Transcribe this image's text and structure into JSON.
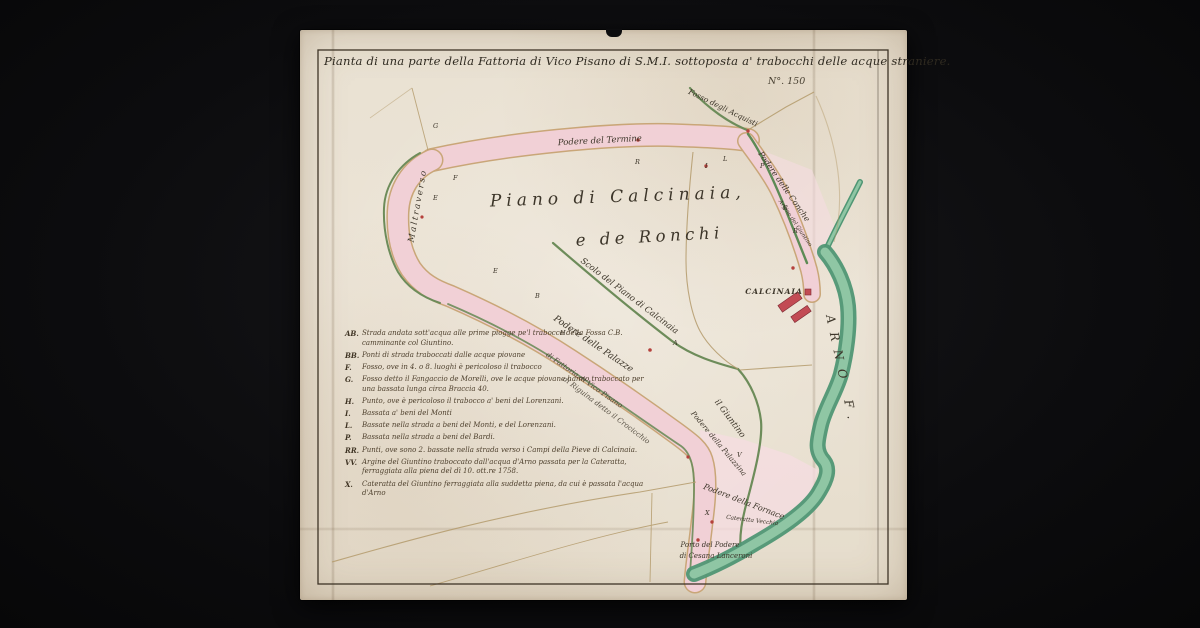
{
  "artifact": {
    "title": "Pianta di una parte della Fattoria di Vico Pisano di S.M.I. sottoposta a' trabocchi delle acque straniere.",
    "sheet_number": "N°. 150"
  },
  "map": {
    "region_title_line1": "Piano di Calcinaia,",
    "region_title_line2": "e de Ronchi",
    "labels": {
      "scolo": "Scolo del Piano di Calcinaia",
      "podere_termine": "Podere del Termine",
      "podere_conche": "Podere delle Conche",
      "fosso_acquisti": "Fosso degli Acquisti",
      "calcinaia": "CALCINAIA",
      "arno": "ARNO F.",
      "podere_palazze": "Podere delle Palazze",
      "strada_fattoria": "di Fattoria di Vico Pisano",
      "riguina": "di Riguina detto il Crocicchio",
      "giuntino": "il Giuntino",
      "argine_giuntino": "Argine del Giuntino",
      "podere_palazzina": "Podere della Palazzina",
      "podere_fornace": "Podere della Fornace",
      "cateratta_vecchia": "Cateratta Vecchia",
      "porto_line1": "Porto del Podere",
      "porto_line2": "di Cesana Lanceroni",
      "maltraverso": "Maltraverso"
    },
    "markers": [
      "F",
      "E",
      "E",
      "B",
      "R",
      "I",
      "L",
      "P",
      "R",
      "R",
      "A",
      "V",
      "X",
      "G",
      "H"
    ]
  },
  "legend": {
    "entries": [
      {
        "key": "AB.",
        "text": "Strada andata sott'acqua alle prime piogge pe'l trabocco della Fossa C.B. camminante col Giuntino."
      },
      {
        "key": "BB.",
        "text": "Ponti di strada traboccati dalle acque piovane"
      },
      {
        "key": "F.",
        "text": "Fosso, ove in 4. o 8. luoghi è pericoloso il trabocco"
      },
      {
        "key": "G.",
        "text": "Fosso detto il Fangaccio de Morelli, ove le acque piovane hanno traboccato per una bassata lunga circa Braccia 40."
      },
      {
        "key": "H.",
        "text": "Punto, ove è pericoloso il trabocco a' beni del Lorenzani."
      },
      {
        "key": "I.",
        "text": "Bassata a' beni del Monti"
      },
      {
        "key": "L.",
        "text": "Bassate nella strada a beni del Monti, e del Lorenzani."
      },
      {
        "key": "P.",
        "text": "Bassata nella strada a beni del Bardi."
      },
      {
        "key": "RR.",
        "text": "Punti, ove sono 2. bassate nella strada verso i Campi della Pieve di Calcinaia."
      },
      {
        "key": "VV.",
        "text": "Argine del Giuntino traboccato dall'acqua d'Arno passata per la Cateratta, ferraggiata alla piena del dì 10. ott.re 1758."
      },
      {
        "key": "X.",
        "text": "Cateratta del Giuntino ferraggiata alla suddetta piena, da cui è passata l'acqua d'Arno"
      }
    ]
  },
  "colors": {
    "paper": "#e9e1d3",
    "ink": "#3c3529",
    "road_pink": "#f1d0d6",
    "road_edge": "#c9a678",
    "river_green": "#4f9674",
    "ditch_green": "#6d8c5a",
    "building_red": "#c24b54"
  }
}
